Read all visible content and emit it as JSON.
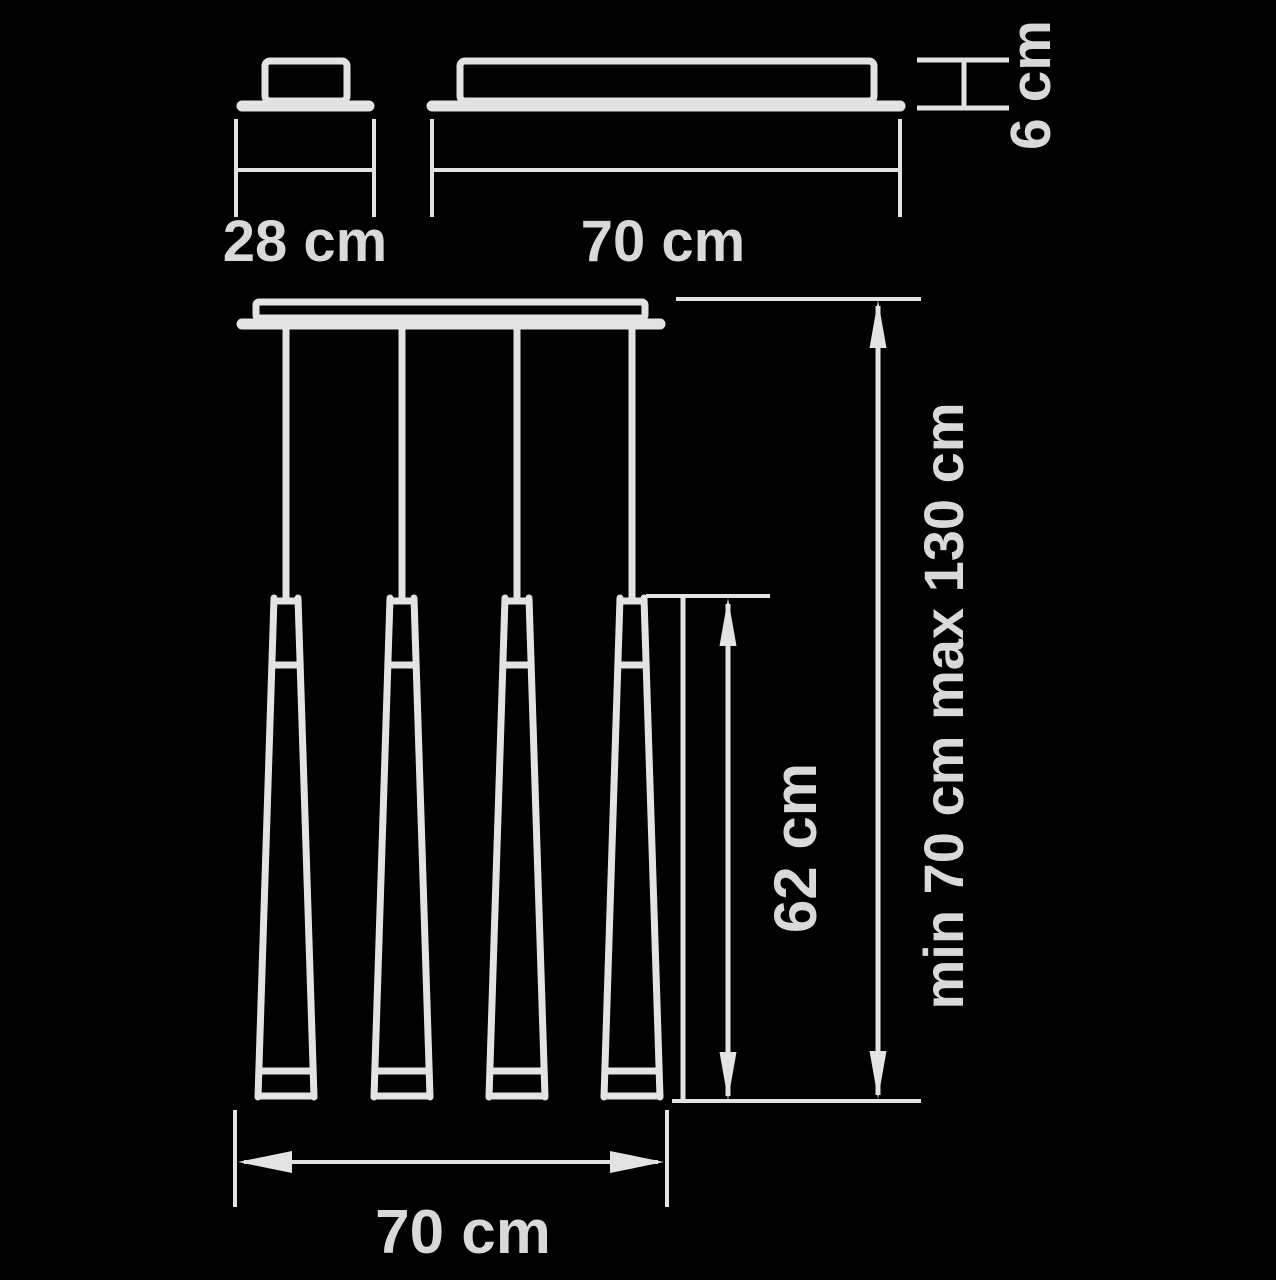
{
  "diagram": {
    "type": "technical-dimension-drawing",
    "subject": "linear suspension lamp with four cone pendants",
    "pendant_count": 4,
    "colors": {
      "background": "#000000",
      "line": "#e3e3e3",
      "text": "#d9d9d9"
    },
    "labels": {
      "canopy_side_width": "28 cm",
      "canopy_front_width": "70 cm",
      "canopy_height": "6 cm",
      "cone_length": "62 cm",
      "suspension_height_range": "min 70 cm max 130 cm",
      "fixture_overall_width": "70 cm"
    }
  }
}
